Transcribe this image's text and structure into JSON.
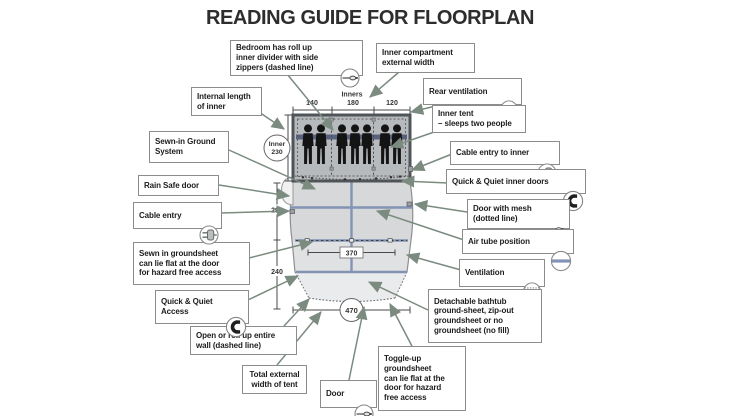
{
  "title": "READING GUIDE FOR FLOORPLAN",
  "callouts": [
    {
      "id": "bedroom-divider",
      "label": "Bedroom has roll up\ninner divider with side\nzippers (dashed line)",
      "icon": "zipper-icon"
    },
    {
      "id": "inner-compartment-external-width",
      "label": "Inner compartment\nexternal width",
      "icon": null
    },
    {
      "id": "rear-ventilation",
      "label": "Rear ventilation",
      "icon": "ventilation-solid-icon"
    },
    {
      "id": "inner-tent",
      "label": "Inner tent\n– sleeps two people",
      "icon": null
    },
    {
      "id": "cable-entry-to-inner",
      "label": "Cable entry to inner",
      "icon": "plug-icon"
    },
    {
      "id": "quick-quiet-inner-doors",
      "label": "Quick & Quiet inner doors",
      "icon": "magnet-icon"
    },
    {
      "id": "door-with-mesh",
      "label": "Door with mesh\n(dotted line)",
      "icon": "mesh-door-icon"
    },
    {
      "id": "air-tube-position",
      "label": "Air tube position",
      "icon": "air-tube-icon"
    },
    {
      "id": "ventilation",
      "label": "Ventilation",
      "icon": "ventilation-dotted-icon"
    },
    {
      "id": "detachable-bathtub-groundsheet",
      "label": "Detachable bathtub\nground-sheet, zip-out\ngroundsheet or no\ngroundsheet (no fill)",
      "icon": null
    },
    {
      "id": "toggle-up-groundsheet",
      "label": "Toggle-up\ngroundsheet\ncan lie flat at the\ndoor for hazard\nfree access",
      "icon": null
    },
    {
      "id": "door",
      "label": "Door",
      "icon": "zipper-icon"
    },
    {
      "id": "total-external-width",
      "label": "Total external\nwidth of tent",
      "icon": null
    },
    {
      "id": "open-or-roll-up-wall",
      "label": "Open or roll up entire\nwall (dashed line)",
      "icon": null
    },
    {
      "id": "quick-quiet-access",
      "label": "Quick & Quiet\nAccess",
      "icon": "magnet-icon"
    },
    {
      "id": "sewn-in-groundsheet",
      "label": "Sewn in groundsheet\ncan lie flat at the door\nfor hazard free access",
      "icon": null
    },
    {
      "id": "cable-entry",
      "label": "Cable entry",
      "icon": "plug-icon"
    },
    {
      "id": "rain-safe-door",
      "label": "Rain Safe door",
      "icon": null
    },
    {
      "id": "sewn-in-ground-system",
      "label": "Sewn-in Ground\nSystem",
      "icon": null
    },
    {
      "id": "internal-length-of-inner",
      "label": "Internal length\nof inner",
      "icon": null
    }
  ],
  "measurements": {
    "inners_label": "Inners",
    "compartment_widths": [
      "140",
      "180",
      "120"
    ],
    "inner_length_circle": {
      "line1": "Inner",
      "line2": "230"
    },
    "mid_length": "290",
    "front_length": "240",
    "inner_width": "370",
    "total_width": "470"
  },
  "floorplan": {
    "sleeping_figures": 7,
    "compartments": 3
  },
  "colors": {
    "arrow": "#7b8b7f",
    "air_tube": "#8293b3",
    "bedroom_band": "#58627e",
    "tent_fill": "#d6d8da",
    "bedroom_fill": "#b7babd",
    "box_border": "#8c8c8c",
    "text": "#1c1c1c"
  }
}
